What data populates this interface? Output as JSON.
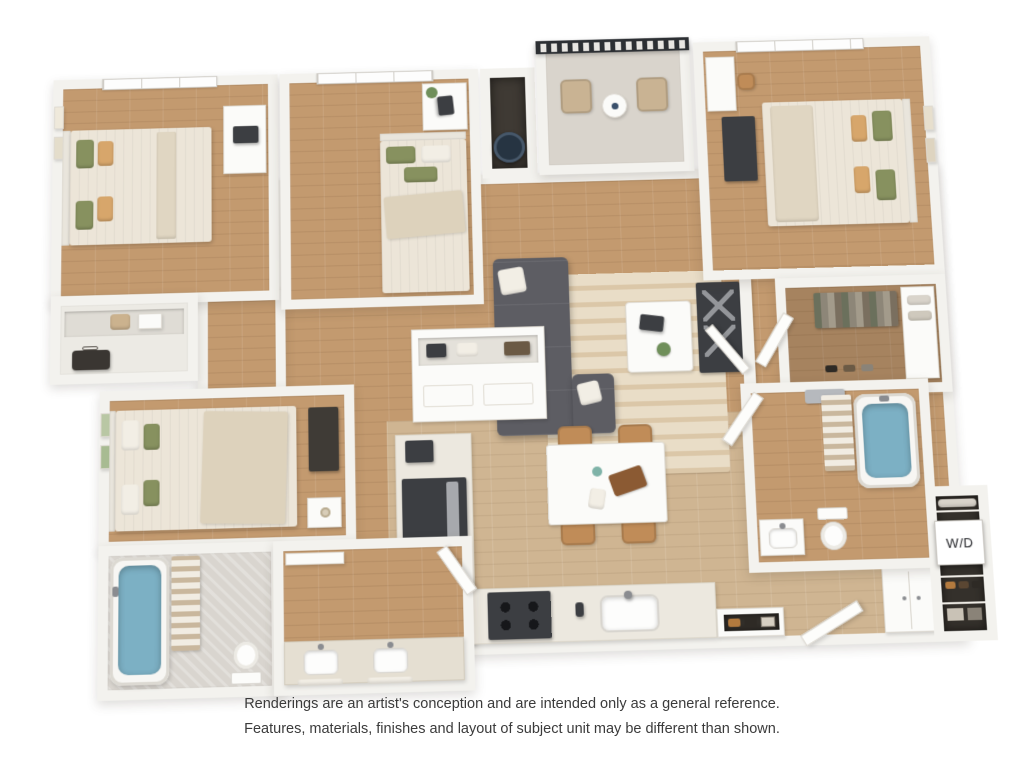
{
  "labels": {
    "washer_dryer": "W/D"
  },
  "disclaimer": {
    "line1": "Renderings are an artist's conception and are intended only as a general reference.",
    "line2": "Features, materials, finishes and layout of subject unit may be different than shown."
  },
  "colors": {
    "wall": "#f3f2ee",
    "wood": "#c39a6f",
    "woodLight": "#cfb592",
    "balconyFloor": "#d9d4cc",
    "rug": "#e9ddc7",
    "rugStripe": "#dbc7a8",
    "sofa": "#5d5d63",
    "pillowWhite": "#f2eee5",
    "pillowGreen": "#87915f",
    "pillowTan": "#d7a66b",
    "duvet": "#ece5d8",
    "water": "#7cb0c4",
    "marble": "#d9d5cf",
    "counter": "#ece8df",
    "island": "#fbfbf9",
    "chairWood": "#c08c58",
    "appliance": "#3c3e42",
    "closetDark": "#34302b",
    "railing": "#2c2f33",
    "plant": "#6f8f5a",
    "textDark": "#3b3b3b"
  }
}
